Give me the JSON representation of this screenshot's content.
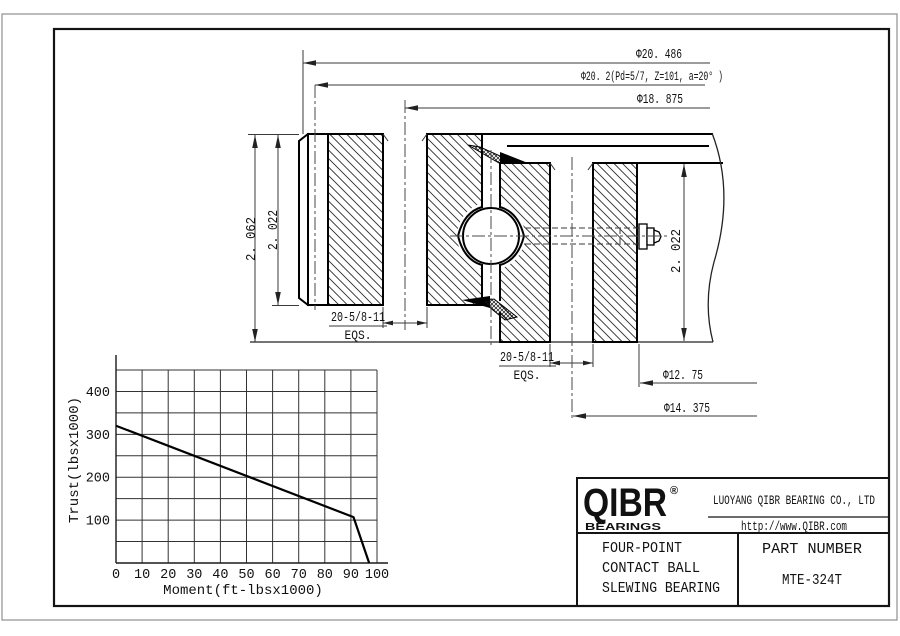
{
  "drawing": {
    "dim_outer_diameter": "Φ20. 486",
    "dim_gear_pitch": "Φ20. 2(Pd=5/7, Z=101, a=20° )",
    "dim_inner_bolt_circle": "Φ18. 875",
    "dim_overall_height": "2. 062",
    "dim_inner_ring_height": "2. 022",
    "dim_outer_ring_height": "2. 022",
    "dim_outer_ring_bore": "Φ12. 75",
    "dim_outer_bolt_circle": "Φ14. 375",
    "inner_bolt_holes": "20-5/8-11",
    "inner_bolt_holes_note": "EQS.",
    "outer_bolt_holes": "20-5/8-11",
    "outer_bolt_holes_note": "EQS."
  },
  "chart_data": {
    "type": "line",
    "title": "",
    "xlabel": "Moment(ft-lbsx1000)",
    "ylabel": "Trust(lbsx1000)",
    "xlim": [
      0,
      100
    ],
    "ylim": [
      0,
      450
    ],
    "x_ticks": [
      0,
      10,
      20,
      30,
      40,
      50,
      60,
      70,
      80,
      90,
      100
    ],
    "y_ticks": [
      100,
      200,
      300,
      400
    ],
    "x_grid_step": 10,
    "y_grid_step": 50,
    "grid": true,
    "legend": "none",
    "series": [
      {
        "name": "allowable-load-curve",
        "points": [
          [
            0,
            320
          ],
          [
            91,
            107
          ],
          [
            97,
            0
          ]
        ]
      }
    ]
  },
  "title_block": {
    "brand": "QIBR",
    "brand_mark": "®",
    "brand_sub": "BEARINGS",
    "company": "LUOYANG QIBR BEARING CO., LTD",
    "website": "http://www.QIBR.com",
    "product_line1": "FOUR-POINT",
    "product_line2": "CONTACT BALL",
    "product_line3": "SLEWING BEARING",
    "part_number_label": "PART NUMBER",
    "part_number": "MTE-324T"
  }
}
